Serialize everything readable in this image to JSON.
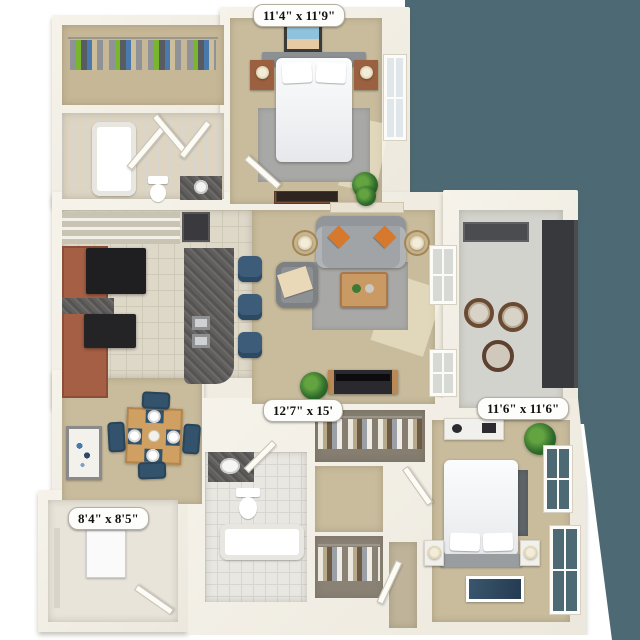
{
  "room_labels": {
    "bedroom_top": "11'4\" x 11'9\"",
    "living_room": "12'7\" x 15'",
    "bedroom_bottom": "11'6\" x 11'6\"",
    "utility_room": "8'4\" x 8'5\""
  },
  "palette": {
    "exterior_backdrop": "#4d6a74",
    "walls": "#f2efe7",
    "carpet": "#c9bc9d",
    "kitchen_tile": "#ded8c9",
    "bath_tile": "#e9e7e1",
    "cabinet_wood": "#a55f45",
    "granite_counter": "#615f5d",
    "sofa_gray": "#a1a4a7",
    "accent_pillow_orange": "#d7792c",
    "dining_chair_blue": "#33536d",
    "balcony_railing": "#37393d",
    "plant_green": "#2f6b2a"
  }
}
